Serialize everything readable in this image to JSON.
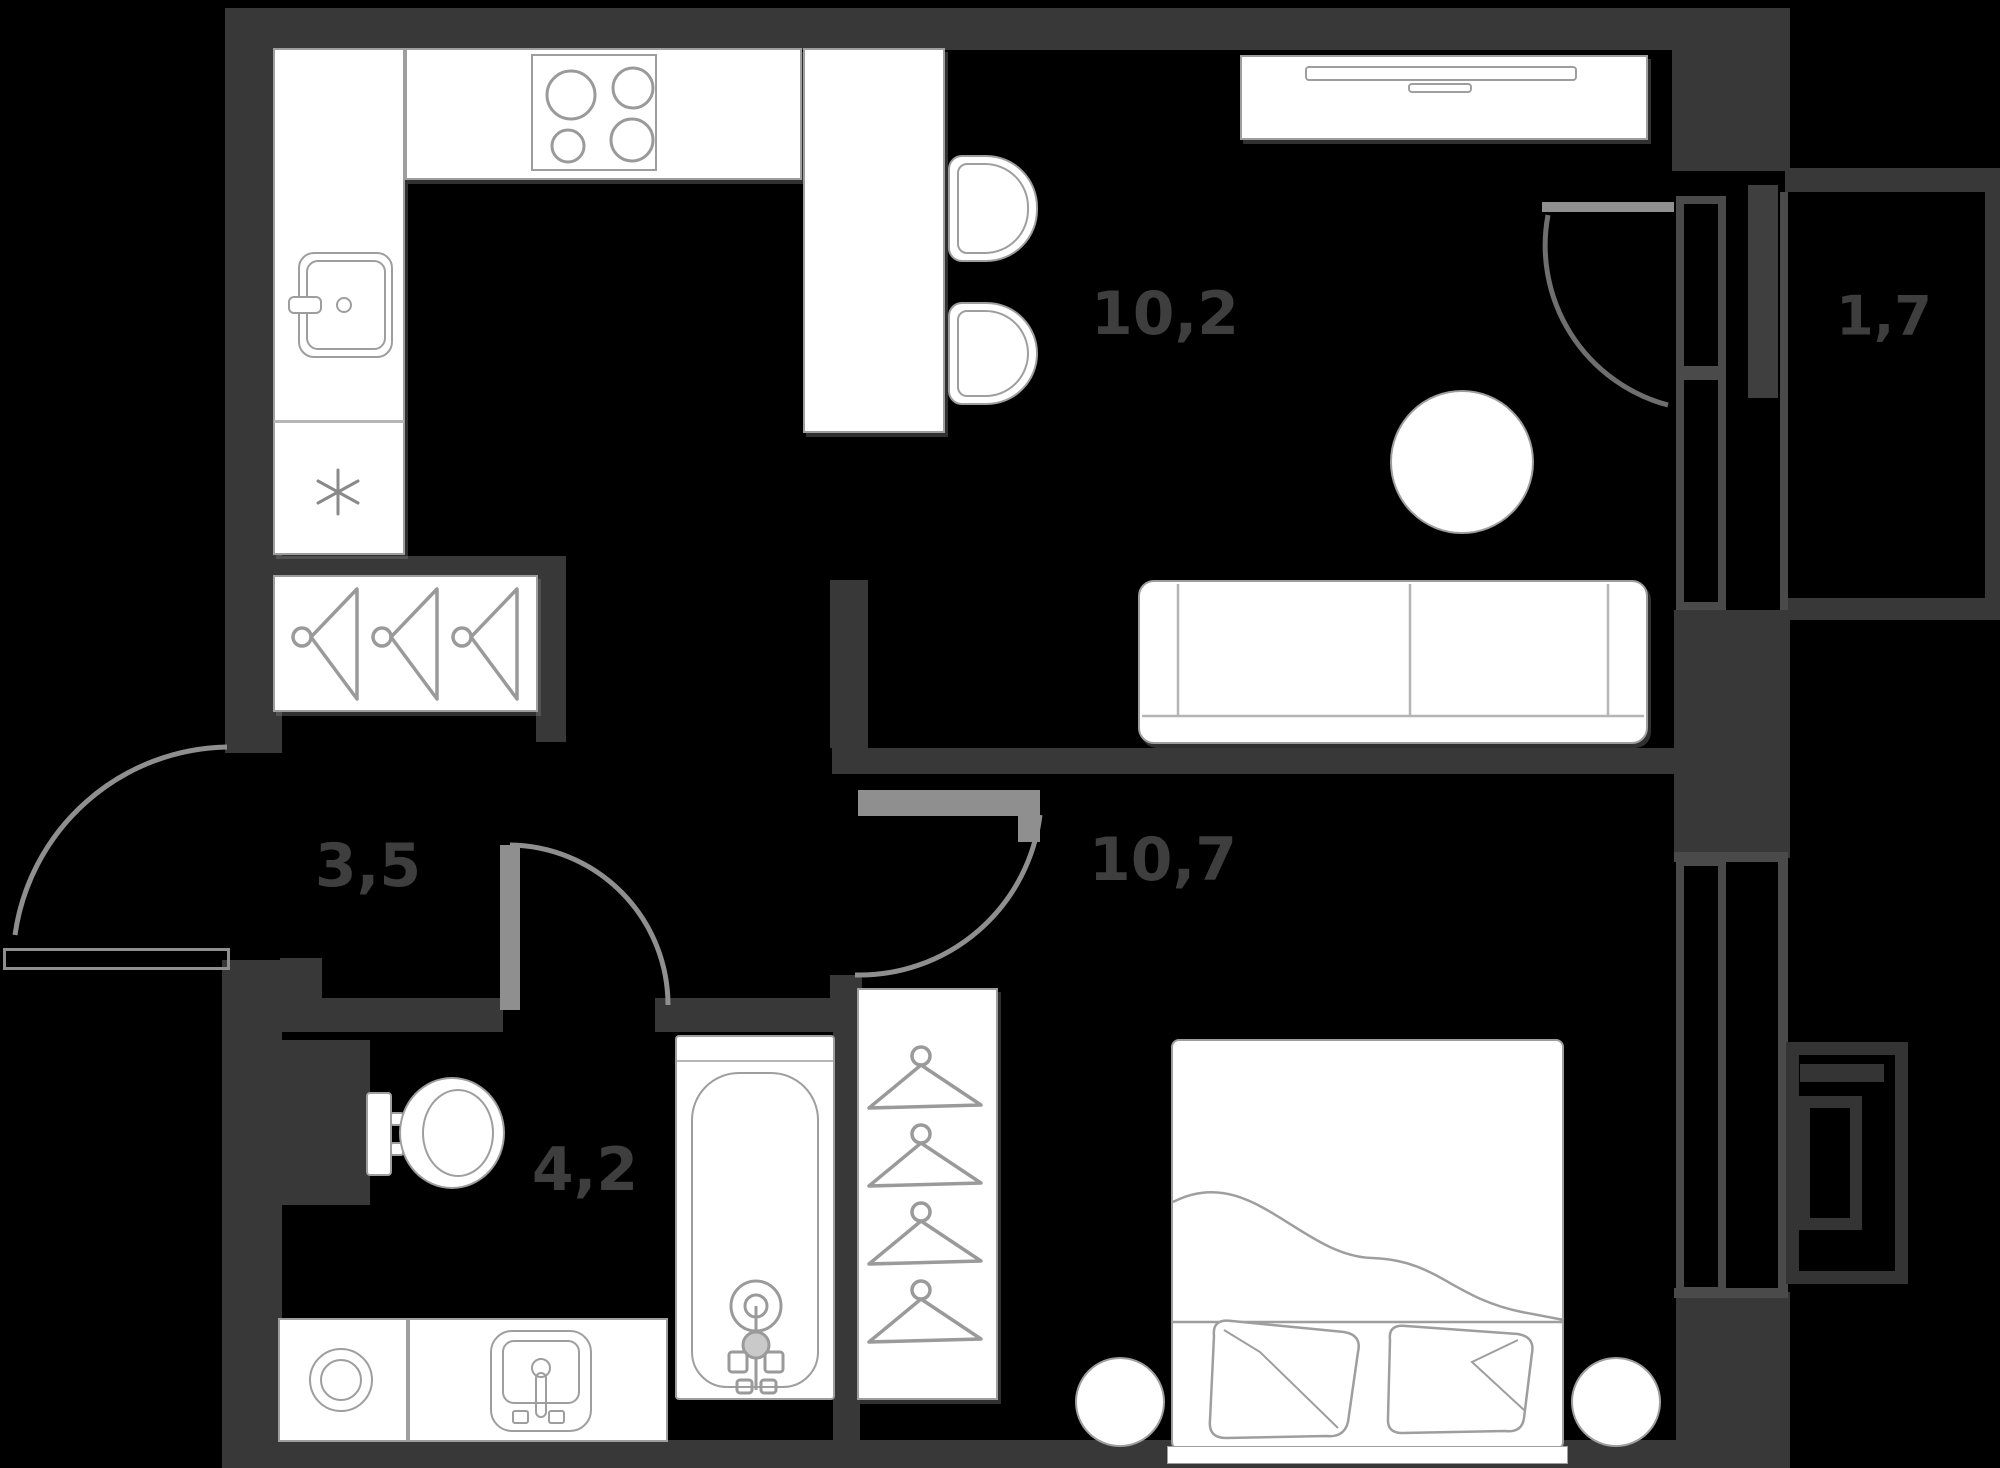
{
  "title": "One-bedroom apartment floor plan",
  "colors": {
    "background": "#000000",
    "wall": "#383838",
    "window": "#4a4a4a",
    "door_swing": "#8f8f8f",
    "furniture_outline": "#9e9e9e",
    "furniture_fill": "#ffffff",
    "room_label": "#3e3e3e"
  },
  "rooms": [
    {
      "name": "kitchen-living-room",
      "area": "10,2"
    },
    {
      "name": "hallway",
      "area": "3,5"
    },
    {
      "name": "bathroom",
      "area": "4,2"
    },
    {
      "name": "bedroom",
      "area": "10,7"
    },
    {
      "name": "balcony",
      "area": "1,7"
    }
  ],
  "fixtures": [
    "stove",
    "kitchen-sink",
    "fridge-snowflake",
    "kitchen-counter",
    "bar-peninsula",
    "bar-stool",
    "tv-cabinet",
    "sofa",
    "round-table",
    "coat-rack",
    "bathtub",
    "toilet",
    "washing-machine",
    "bathroom-sink",
    "wardrobe-with-hangers",
    "double-bed",
    "pillow",
    "nightstand",
    "entry-door",
    "bathroom-door",
    "bedroom-door",
    "balcony-door",
    "window",
    "air-conditioner-basket"
  ]
}
